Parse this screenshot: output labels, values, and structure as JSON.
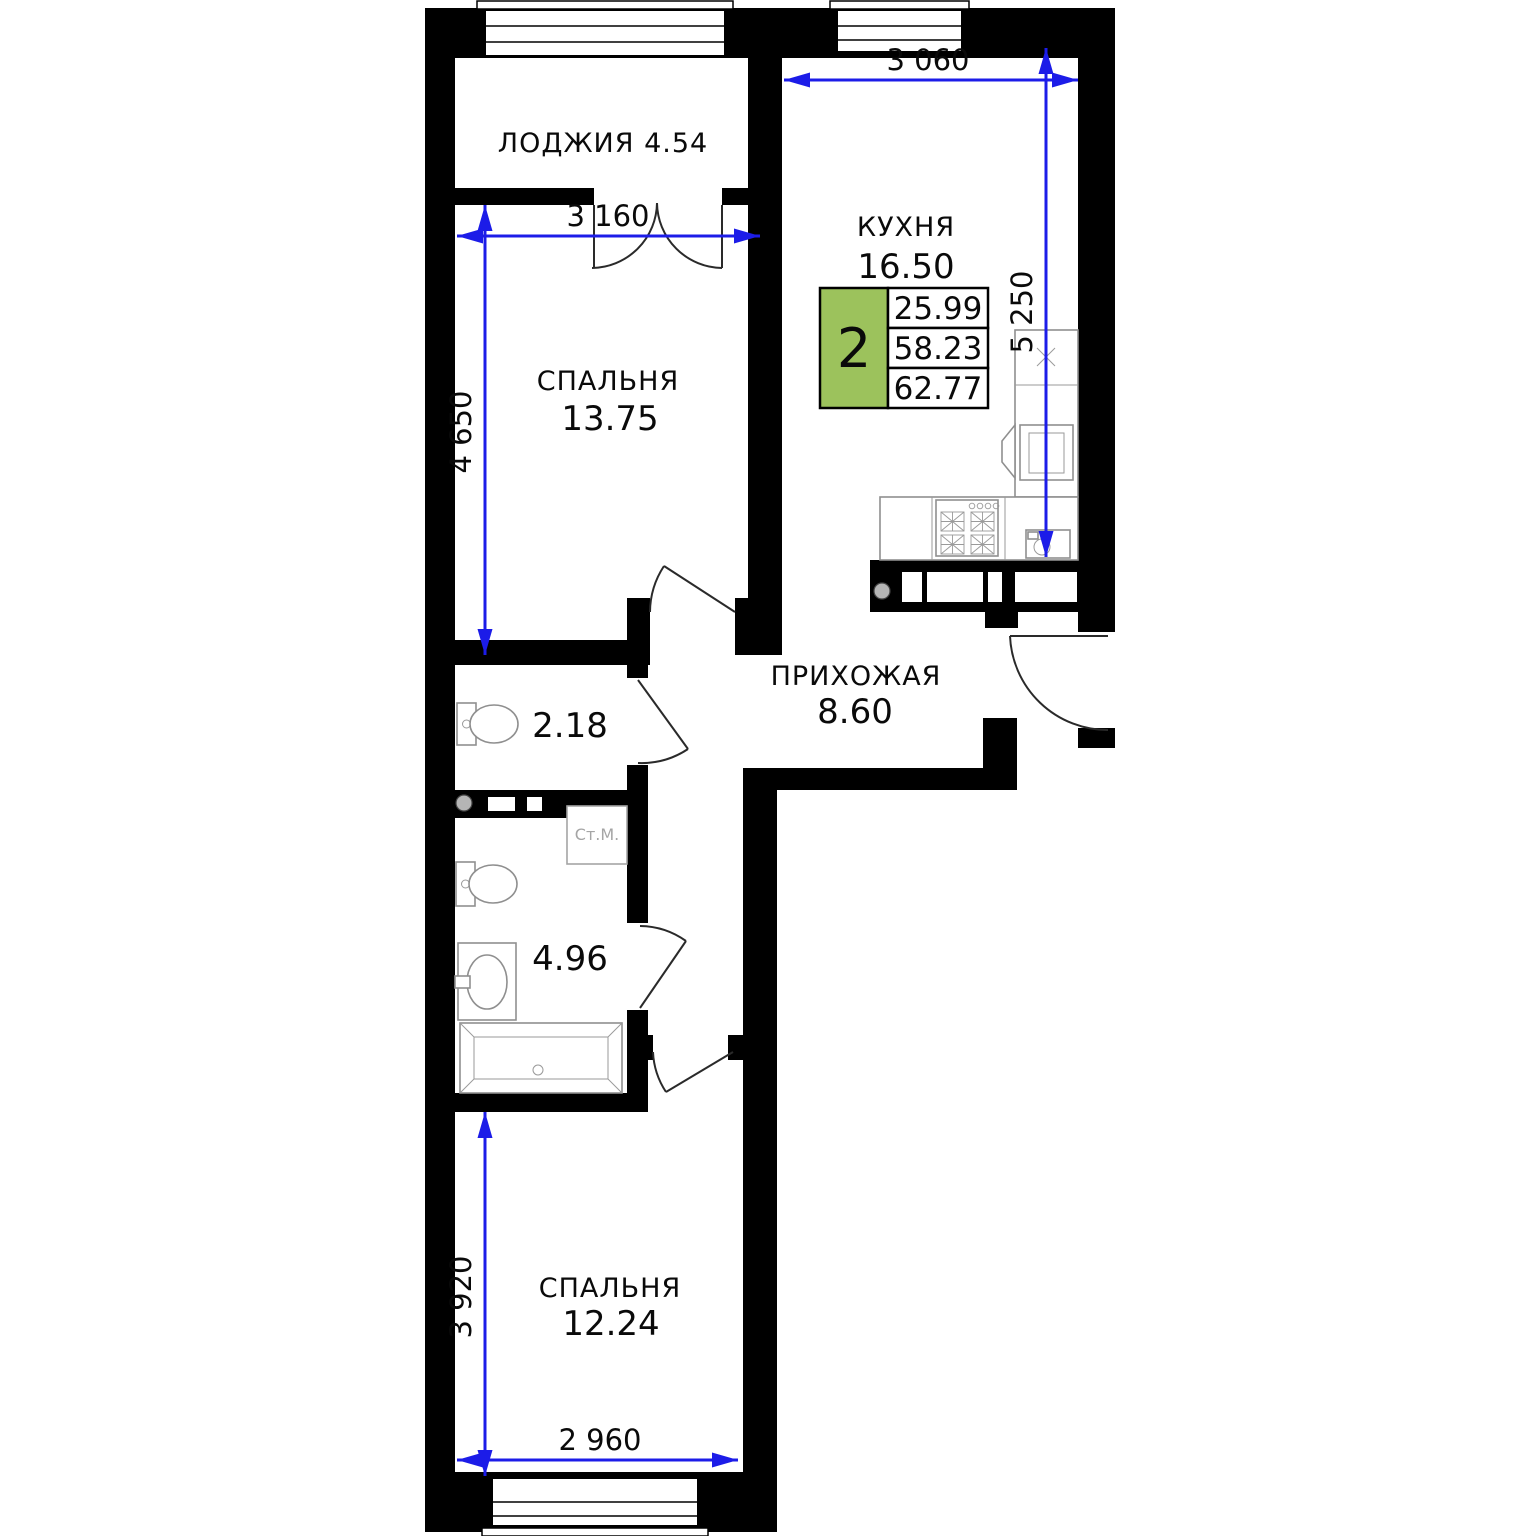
{
  "rooms": {
    "loggia": {
      "label": "ЛОДЖИЯ 4.54"
    },
    "kitchen": {
      "name": "КУХНЯ",
      "area": "16.50"
    },
    "bedroom1": {
      "name": "СПАЛЬНЯ",
      "area": "13.75"
    },
    "hallway": {
      "name": "ПРИХОЖАЯ",
      "area": "8.60"
    },
    "wc": {
      "area": "2.18"
    },
    "bathroom": {
      "area": "4.96"
    },
    "bedroom2": {
      "name": "СПАЛЬНЯ",
      "area": "12.24"
    }
  },
  "info_box": {
    "rooms_count": "2",
    "living_area": "25.99",
    "usable_area": "58.23",
    "total_area": "62.77"
  },
  "dimensions": {
    "kitchen_width": "3 060",
    "kitchen_depth": "5 250",
    "bedroom1_width": "3 160",
    "bedroom1_depth": "4 650",
    "bedroom2_depth": "3 920",
    "bedroom2_width": "2 960"
  },
  "fixtures": {
    "washing_machine": "Ст.М."
  },
  "colors": {
    "info_green": "#9cc25c",
    "dimension_blue": "#1c1ce8"
  }
}
